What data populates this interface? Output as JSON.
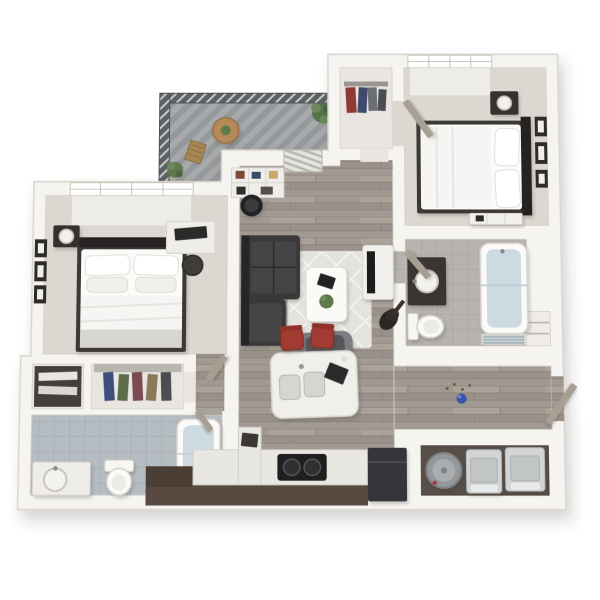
{
  "image": {
    "type": "3d-floor-plan-rendering",
    "description": "Isometric 3D floor plan of a two-bedroom, two-bathroom apartment with balcony, open living/kitchen area and laundry room",
    "background": "#ffffff"
  },
  "colors": {
    "wall": "#f6f4f0",
    "wall_edge": "#d9d5cd",
    "wood": "#a29a92",
    "carpet": "#dcd8d1",
    "closet_floor": "#e9e6e1",
    "laundry_floor": "#574f48",
    "railing": "#5d6164",
    "balcony_floor": "#a7a9ab",
    "counter": "#e9e7e2",
    "cabinet": "#584a40",
    "cabinet_dark": "#4a3e35",
    "island": "#f1efeb",
    "cooktop": "#1f1f20",
    "fridge": "#35363a",
    "sofa": "#3a393b",
    "sofa_dark": "#28272a",
    "rug": "#e5e3de",
    "armchair": "#7d7d80",
    "armchair_seat": "#55555a",
    "table_white": "#fafaf8",
    "stool_red": "#a23b33",
    "bedding": "#fbfbfa",
    "duvet": "#f6f5f3",
    "bed_frame": "#3a3735",
    "headboard": "#262423",
    "nightstand": "#35322f",
    "lamp": "#f2f0ec",
    "desk": "#efede9",
    "monitor": "#2c2a29",
    "console": "#f2f0ec",
    "tv": "#1d1d1f",
    "guitar": "#2a2724",
    "plant": "#5d7a4d",
    "plant_dark": "#4a6540",
    "wood_table": "#b5895a",
    "vanity_dark": "#3a3632",
    "porcelain": "#f4f2ee",
    "water": "#ccdbe2",
    "towel": "#9fb2bc",
    "heater": "#94989b",
    "appliance": "#d2d4d5",
    "door": "#a89f93",
    "shelf_dark": "#453f3a",
    "ball_blue": "#3b55ae",
    "window": "#ffffff"
  },
  "clothes": {
    "closet1": [
      "#3e4f7e",
      "#5c6b4a",
      "#7b4a52",
      "#8a7a5a",
      "#4a4e52"
    ],
    "closet2": [
      "#8f3a34",
      "#3f4a6e",
      "#6b6f73",
      "#4a4e52"
    ]
  },
  "books": [
    "#7a4a3a",
    "#3a4a6a",
    "#caa86a",
    "#2e2e30"
  ],
  "rooms": [
    {
      "name": "balcony",
      "items": [
        "railing",
        "bistro-table",
        "folding-chair",
        "potted-plant",
        "potted-plant"
      ]
    },
    {
      "name": "bedroom-1",
      "items": [
        "window",
        "bed",
        "pillows",
        "nightstand",
        "lamp",
        "desk",
        "computer-monitor",
        "desk-chair",
        "wall-frames"
      ]
    },
    {
      "name": "bedroom-2",
      "items": [
        "window",
        "bed",
        "pillows",
        "nightstand",
        "lamp",
        "dresser",
        "wall-frames",
        "door"
      ]
    },
    {
      "name": "living-room",
      "items": [
        "sectional-sofa",
        "area-rug",
        "coffee-table",
        "plant",
        "armchair",
        "tv-console",
        "tv",
        "guitar",
        "bookcase",
        "tub-chair",
        "balcony-door-blinds"
      ]
    },
    {
      "name": "kitchen",
      "items": [
        "island",
        "double-sink",
        "bar-stool",
        "bar-stool",
        "counter",
        "cooktop",
        "refrigerator",
        "return-counter"
      ]
    },
    {
      "name": "bathroom-1",
      "items": [
        "vanity-sink",
        "toilet",
        "bathtub"
      ]
    },
    {
      "name": "bathroom-2",
      "items": [
        "vanity-sink",
        "toilet",
        "bathtub",
        "towel-shelf",
        "door"
      ]
    },
    {
      "name": "walk-in-closet",
      "items": [
        "shelf",
        "hanging-clothes"
      ]
    },
    {
      "name": "hall-closet",
      "items": [
        "hanging-clothes"
      ]
    },
    {
      "name": "linen-nook",
      "items": [
        "shelf",
        "towels"
      ]
    },
    {
      "name": "entry",
      "items": [
        "front-door",
        "pet-ball",
        "entry-niche"
      ]
    },
    {
      "name": "laundry",
      "items": [
        "water-heater",
        "washer",
        "dryer"
      ]
    }
  ]
}
